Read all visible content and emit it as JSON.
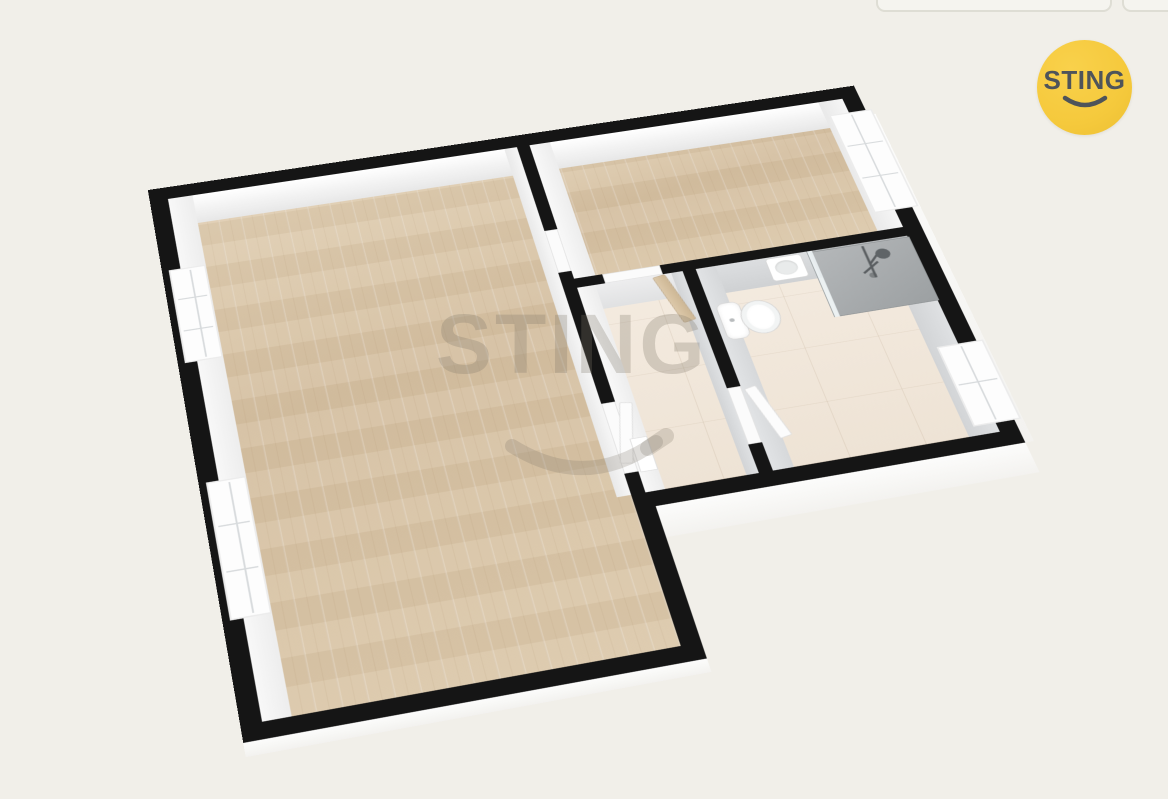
{
  "watermark": {
    "text": "STING"
  },
  "logo": {
    "text": "STING"
  },
  "colors": {
    "bg": "#f1efe9",
    "wall": "#151515",
    "wood": "#d9c5a8",
    "wood-light": "#e2d1b6",
    "tile": "#f1e8dc",
    "logo-yellow": "#f5c93c",
    "logo-ink": "#4e545a",
    "wm": "rgba(125,118,104,0.28)"
  },
  "rooms": [
    {
      "name": "living-room",
      "floor": "wood"
    },
    {
      "name": "bedroom",
      "floor": "wood"
    },
    {
      "name": "hallway",
      "floor": "tile"
    },
    {
      "name": "bathroom",
      "floor": "tile"
    }
  ],
  "fixtures": [
    "toilet",
    "sink",
    "shower"
  ],
  "windows": {
    "living_room": 2,
    "bedroom": 1,
    "bathroom": 1
  }
}
